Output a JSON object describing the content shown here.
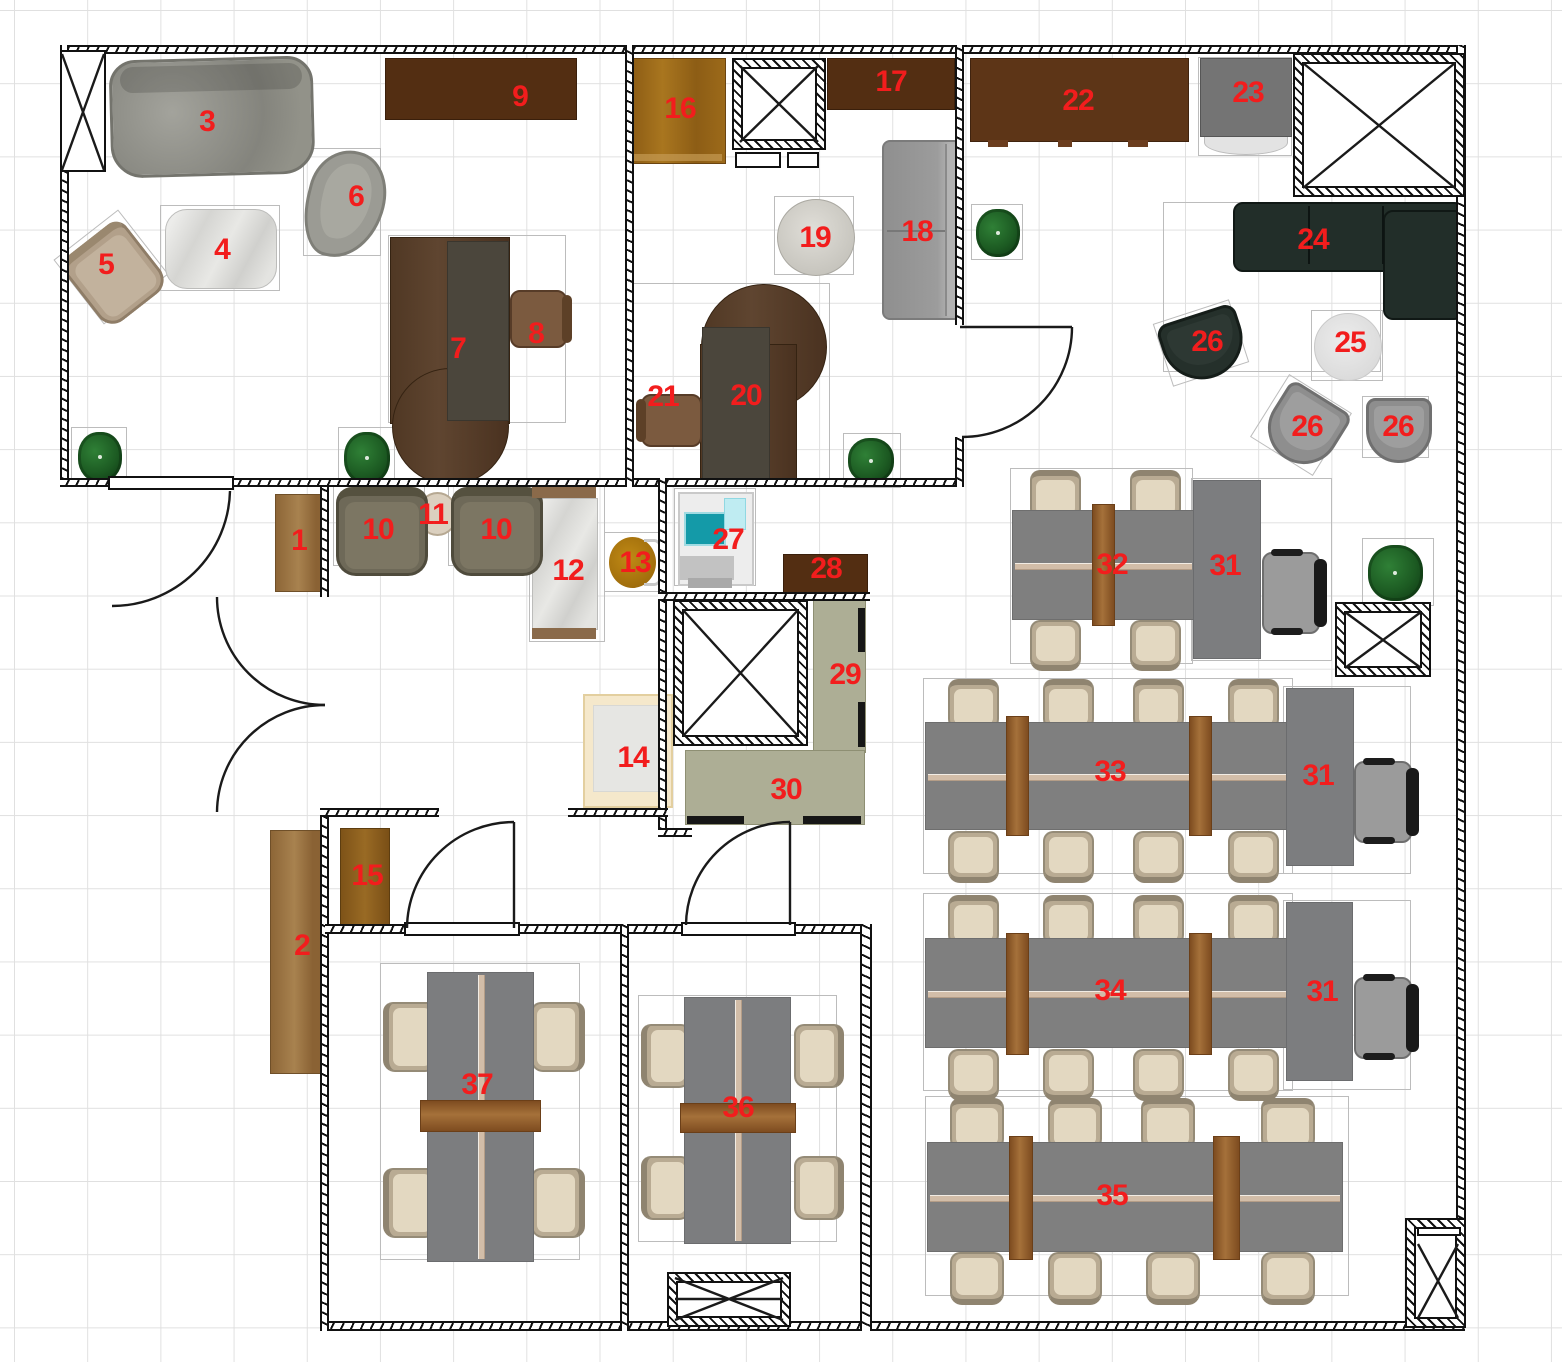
{
  "title": "Office floor plan",
  "colors": {
    "label_red": "#f21d1d",
    "wall_black": "#111111",
    "wood_dark_cabinet": "#532e12",
    "wood_mid": "#9a6331",
    "desk_gray": "#7f7f7f",
    "counter_olive": "#adae95",
    "sofa_dark": "#222e29",
    "chair_beige": "#e3d8c1",
    "plant_green": "#1c5a22",
    "marble": "#dcdcd9"
  },
  "labels": {
    "1": "1",
    "2": "2",
    "3": "3",
    "4": "4",
    "5": "5",
    "6": "6",
    "7": "7",
    "8": "8",
    "9": "9",
    "10": "10",
    "11": "11",
    "12": "12",
    "13": "13",
    "14": "14",
    "15": "15",
    "16": "16",
    "17": "17",
    "18": "18",
    "19": "19",
    "20": "20",
    "21": "21",
    "22": "22",
    "23": "23",
    "24": "24",
    "25": "25",
    "26": "26",
    "27": "27",
    "28": "28",
    "29": "29",
    "30": "30",
    "31": "31",
    "32": "32",
    "33": "33",
    "34": "34",
    "35": "35",
    "36": "36",
    "37": "37"
  }
}
